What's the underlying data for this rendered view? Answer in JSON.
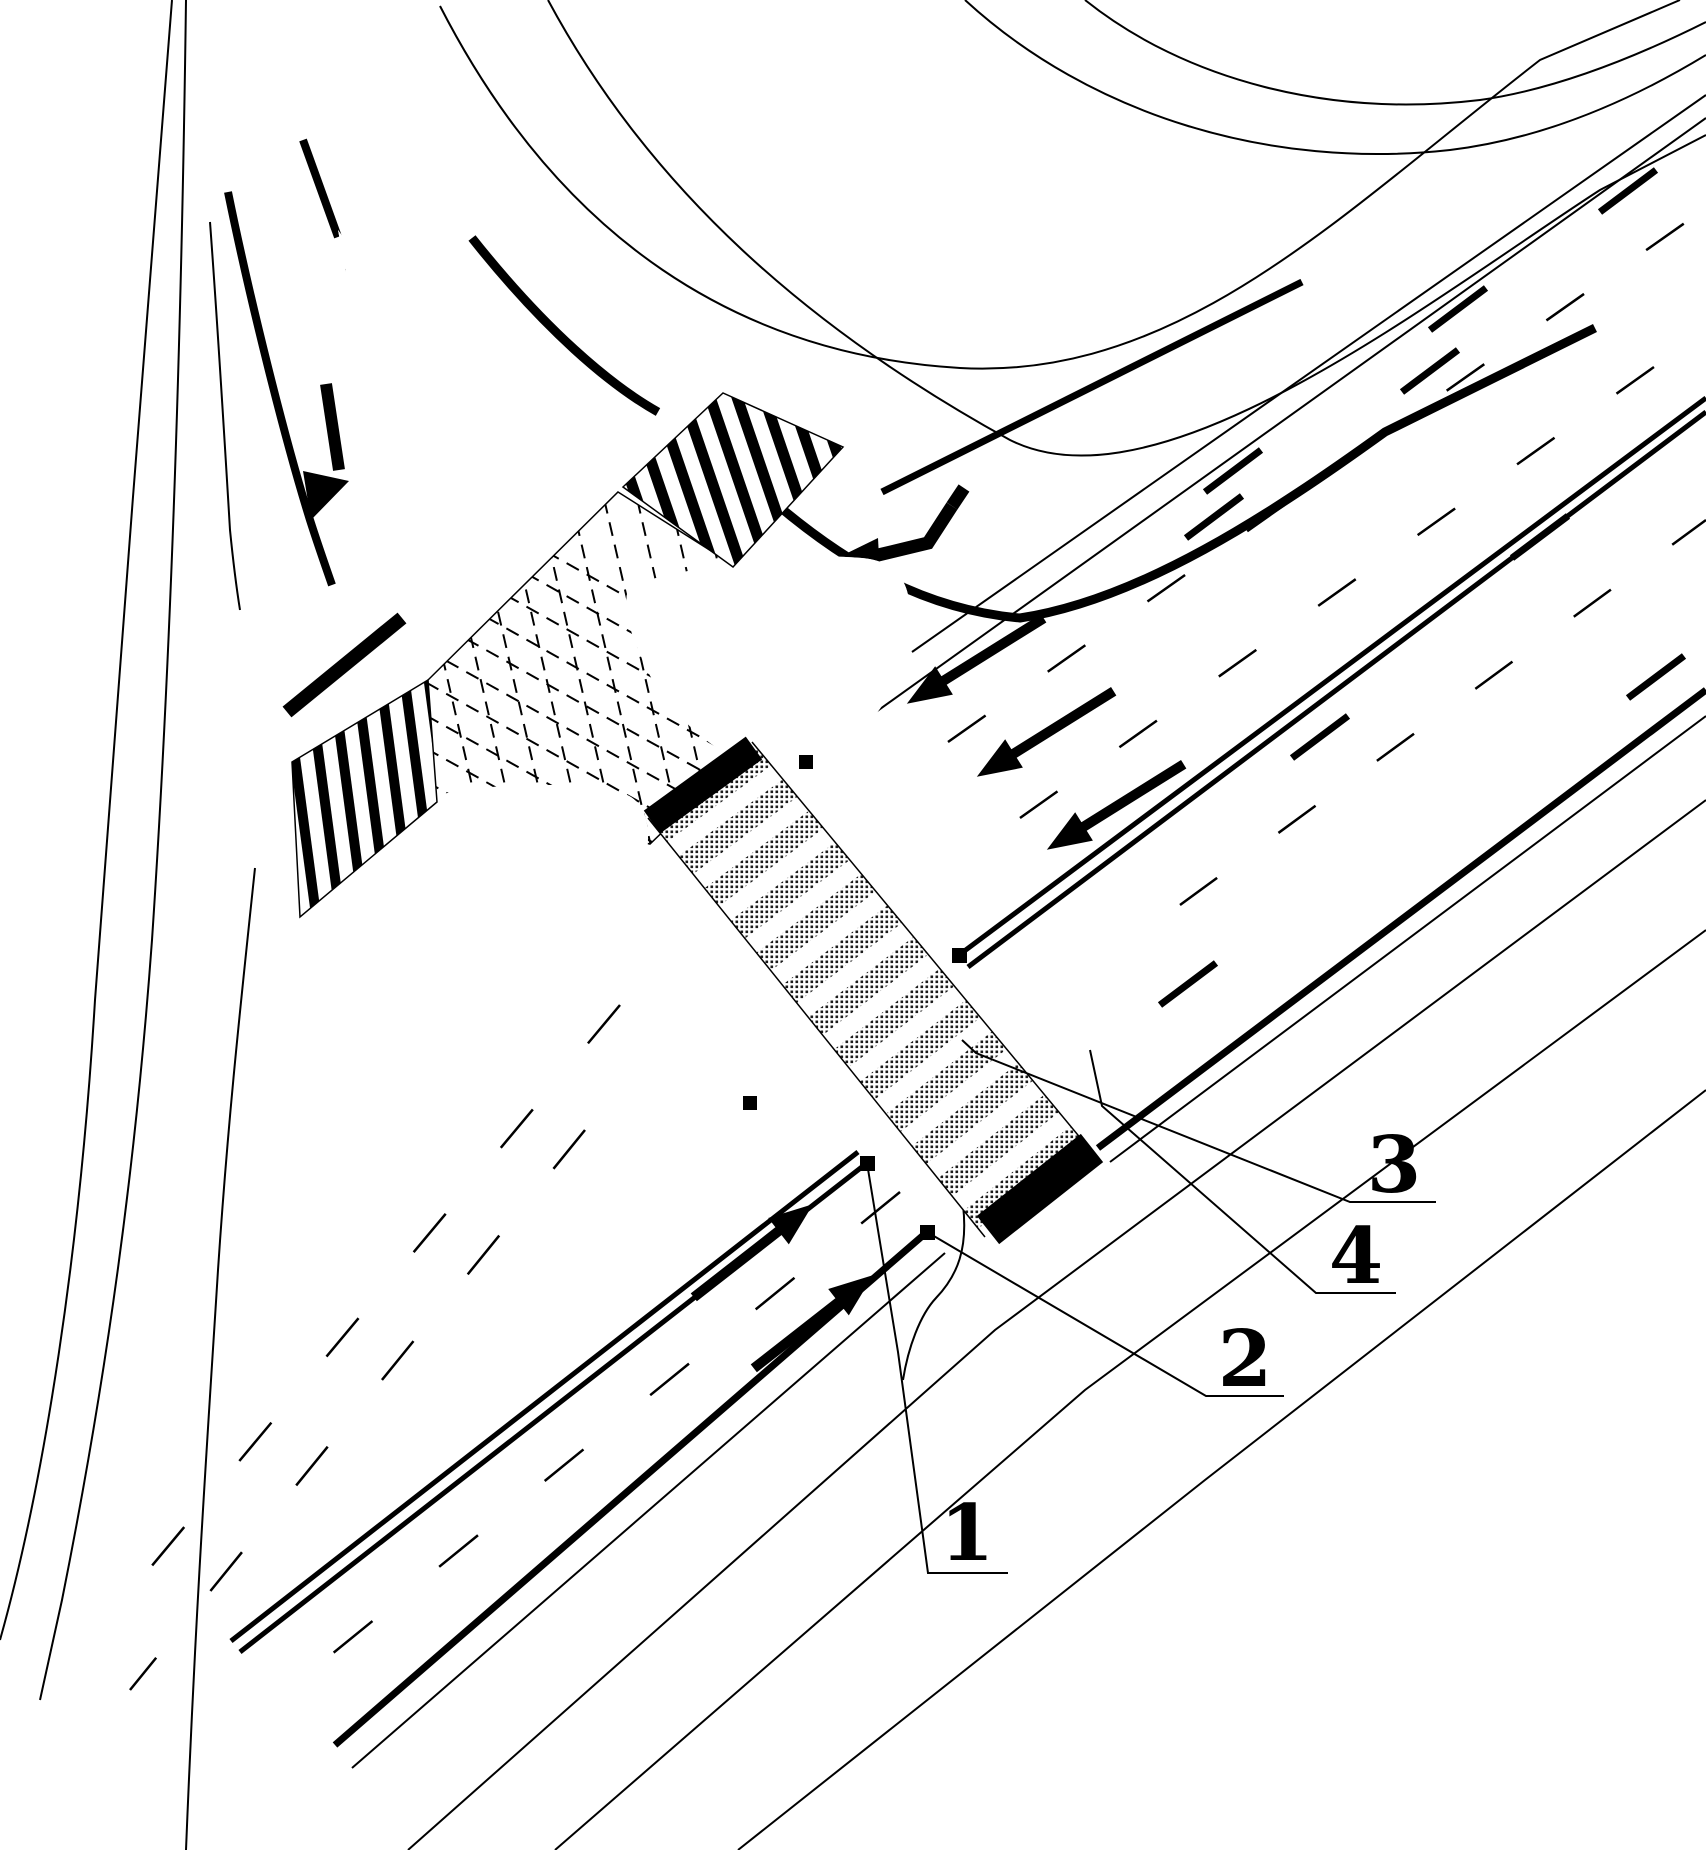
{
  "figure": {
    "type": "patent-style road intersection plan drawing",
    "colors": {
      "background": "#ffffff",
      "ink": "#000000"
    },
    "callouts": [
      {
        "label": "1"
      },
      {
        "label": "2"
      },
      {
        "label": "3"
      },
      {
        "label": "4"
      }
    ]
  }
}
